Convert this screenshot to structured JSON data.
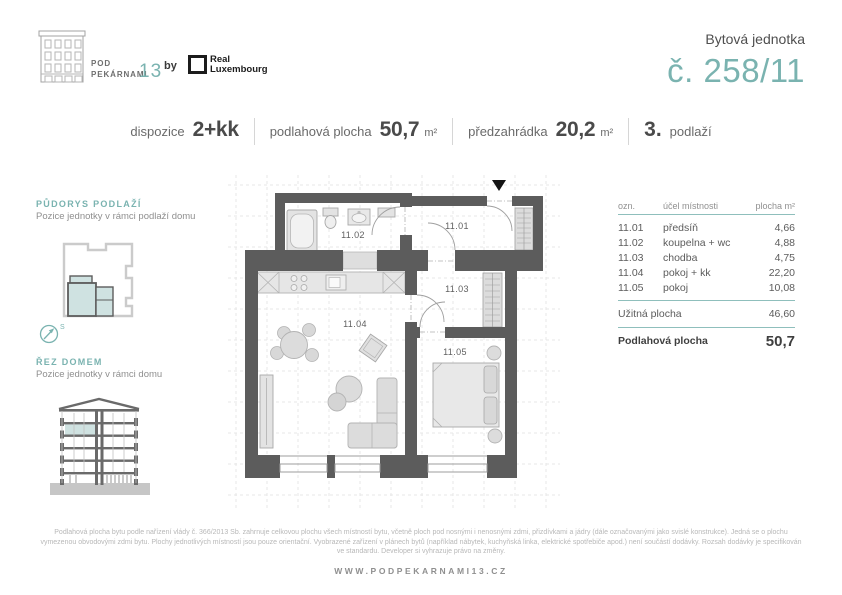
{
  "colors": {
    "accent": "#7ab3b0",
    "wall": "#5c5c5c"
  },
  "brand": {
    "name_line1": "POD",
    "name_line2": "PEKÁRNAMI",
    "number": "13",
    "by": "by",
    "partner_line1": "Real",
    "partner_line2": "Luxembourg"
  },
  "header": {
    "unit_label": "Bytová jednotka",
    "unit_number": "č. 258/11"
  },
  "specs": {
    "dispozice_label": "dispozice",
    "dispozice_value": "2+kk",
    "plocha_label": "podlahová plocha",
    "plocha_value": "50,7",
    "plocha_unit": "m²",
    "zahradka_label": "předzahrádka",
    "zahradka_value": "20,2",
    "zahradka_unit": "m²",
    "podlazi_value": "3.",
    "podlazi_label": "podlaží"
  },
  "sidebar": {
    "floorplan_title": "PŮDORYS PODLAŽÍ",
    "floorplan_subtitle": "Pozice jednotky v rámci podlaží domu",
    "compass_label": "S",
    "section_title": "ŘEZ DOMEM",
    "section_subtitle": "Pozice jednotky v rámci domu"
  },
  "plan": {
    "rooms": [
      {
        "id": "11.01"
      },
      {
        "id": "11.02"
      },
      {
        "id": "11.03"
      },
      {
        "id": "11.04"
      },
      {
        "id": "11.05"
      }
    ]
  },
  "table": {
    "headers": {
      "ozn": "ozn.",
      "ucel": "účel místnosti",
      "plocha": "plocha m²"
    },
    "rows": [
      {
        "ozn": "11.01",
        "ucel": "předsíň",
        "plocha": "4,66"
      },
      {
        "ozn": "11.02",
        "ucel": "koupelna + wc",
        "plocha": "4,88"
      },
      {
        "ozn": "11.03",
        "ucel": "chodba",
        "plocha": "4,75"
      },
      {
        "ozn": "11.04",
        "ucel": "pokoj + kk",
        "plocha": "22,20"
      },
      {
        "ozn": "11.05",
        "ucel": "pokoj",
        "plocha": "10,08"
      }
    ],
    "uzitna_label": "Užitná plocha",
    "uzitna_value": "46,60",
    "podlahova_label": "Podlahová plocha",
    "podlahova_value": "50,7"
  },
  "legal": {
    "text": "Podlahová plocha bytu podle nařízení vlády č. 366/2013 Sb. zahrnuje celkovou plochu všech místností bytu, včetně ploch pod nosnými i nenosnými zdmi, přizdívkami a jádry (dále označovanými jako svislé konstrukce). Jedná se o plochu vymezenou obvodovými zdmi bytu. Plochy jednotlivých místností jsou pouze orientační. Vyobrazené zařízení v plánech bytů (například nábytek, kuchyňská linka, elektrické spotřebiče apod.) není součástí dodávky. Rozsah dodávky je specifikován ve standardu. Developer si vyhrazuje právo na změny."
  },
  "footer": {
    "url": "WWW.PODPEKARNAMI13.CZ"
  }
}
